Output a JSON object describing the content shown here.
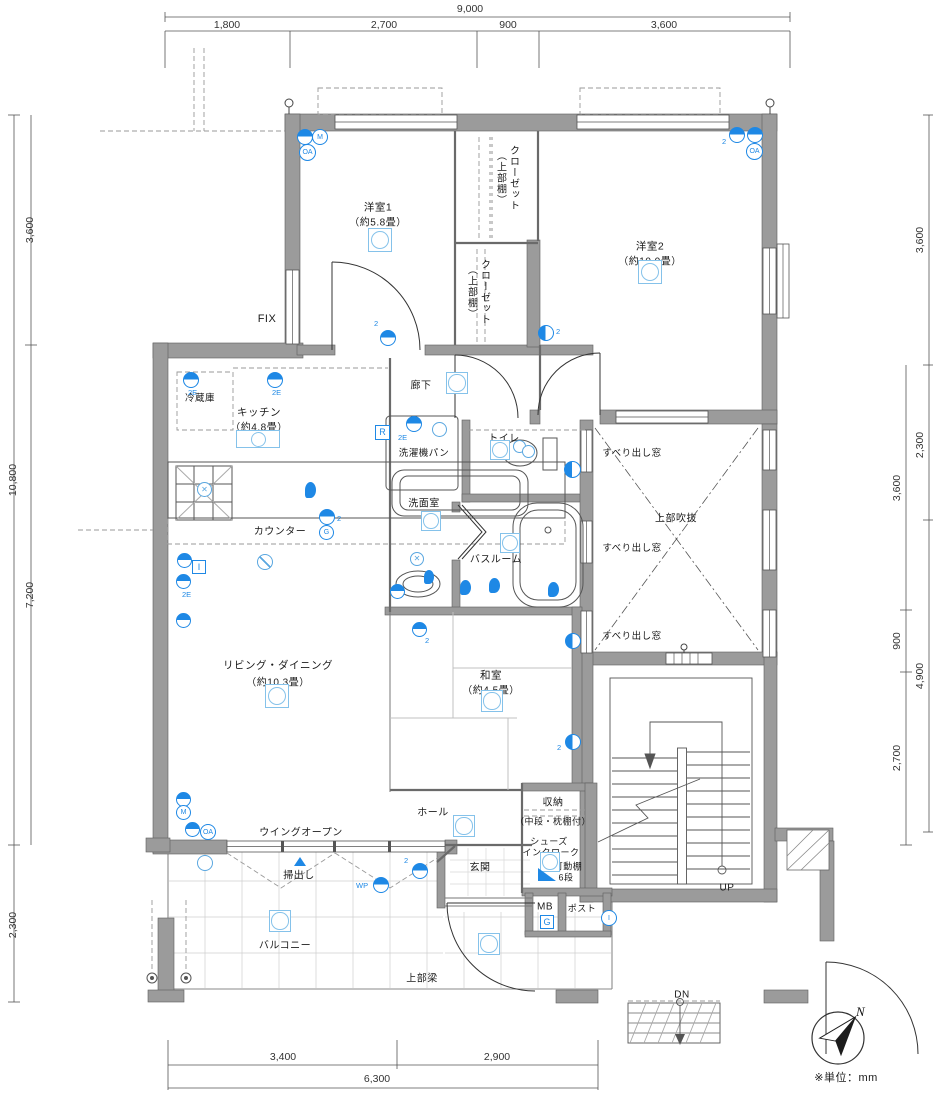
{
  "meta": {
    "unit_note": "※単位：mm",
    "compass_north": "N"
  },
  "dims": {
    "top_total": "9,000",
    "top_segs": [
      "1,800",
      "2,700",
      "900",
      "3,600"
    ],
    "left_total": "10,800",
    "left_segs": [
      "3,600",
      "7,200"
    ],
    "left_balcony": "2,300",
    "right_outer": [
      "3,600",
      "2,300",
      "4,900"
    ],
    "right_inner": [
      "3,600",
      "900",
      "2,700"
    ],
    "bottom_segs": [
      "3,400",
      "2,900"
    ],
    "bottom_total": "6,300"
  },
  "rooms": {
    "yoshitsu1": {
      "name": "洋室1",
      "size": "（約5.8畳）"
    },
    "yoshitsu2": {
      "name": "洋室2",
      "size": "（約10.0畳）"
    },
    "kitchen": {
      "name": "キッチン",
      "size": "（約4.8畳）"
    },
    "living": {
      "name": "リビング・ダイニング",
      "size": "（約10.3畳）"
    },
    "washitsu": {
      "name": "和室",
      "size": "（約4.5畳）"
    },
    "closet": {
      "name": "クローゼット",
      "note": "（上部棚）"
    },
    "reizouko": "冷蔵庫",
    "counter": "カウンター",
    "rouka": "廊下",
    "sentakuki_pan": "洗濯機パン",
    "toilet": "トイレ",
    "senmen": "洗面室",
    "bath": "バスルーム",
    "hall": "ホール",
    "genkan": "玄関",
    "shuno": {
      "name": "収納",
      "note": "（中段・枕棚付）"
    },
    "shoes": {
      "line1": "シューズ",
      "line2": "インクローク"
    },
    "kadoudana": {
      "line1": "可動棚",
      "line2": "6段"
    },
    "mb": "MB",
    "post": "ポスト",
    "balcony": "バルコニー"
  },
  "labels": {
    "fix": "FIX",
    "fukinuki": "上部吹抜",
    "suberidashi": "すべり出し窓",
    "wing_open": "ウイングオープン",
    "hakidashi": "掃出し",
    "joubu_hari": "上部梁",
    "up": "UP",
    "dn": "DN"
  },
  "symbols": {
    "m": "M",
    "oa": "OA",
    "r": "R",
    "g": "G",
    "i": "I",
    "wp": "WP",
    "e2": "2E",
    "n2": "2"
  }
}
